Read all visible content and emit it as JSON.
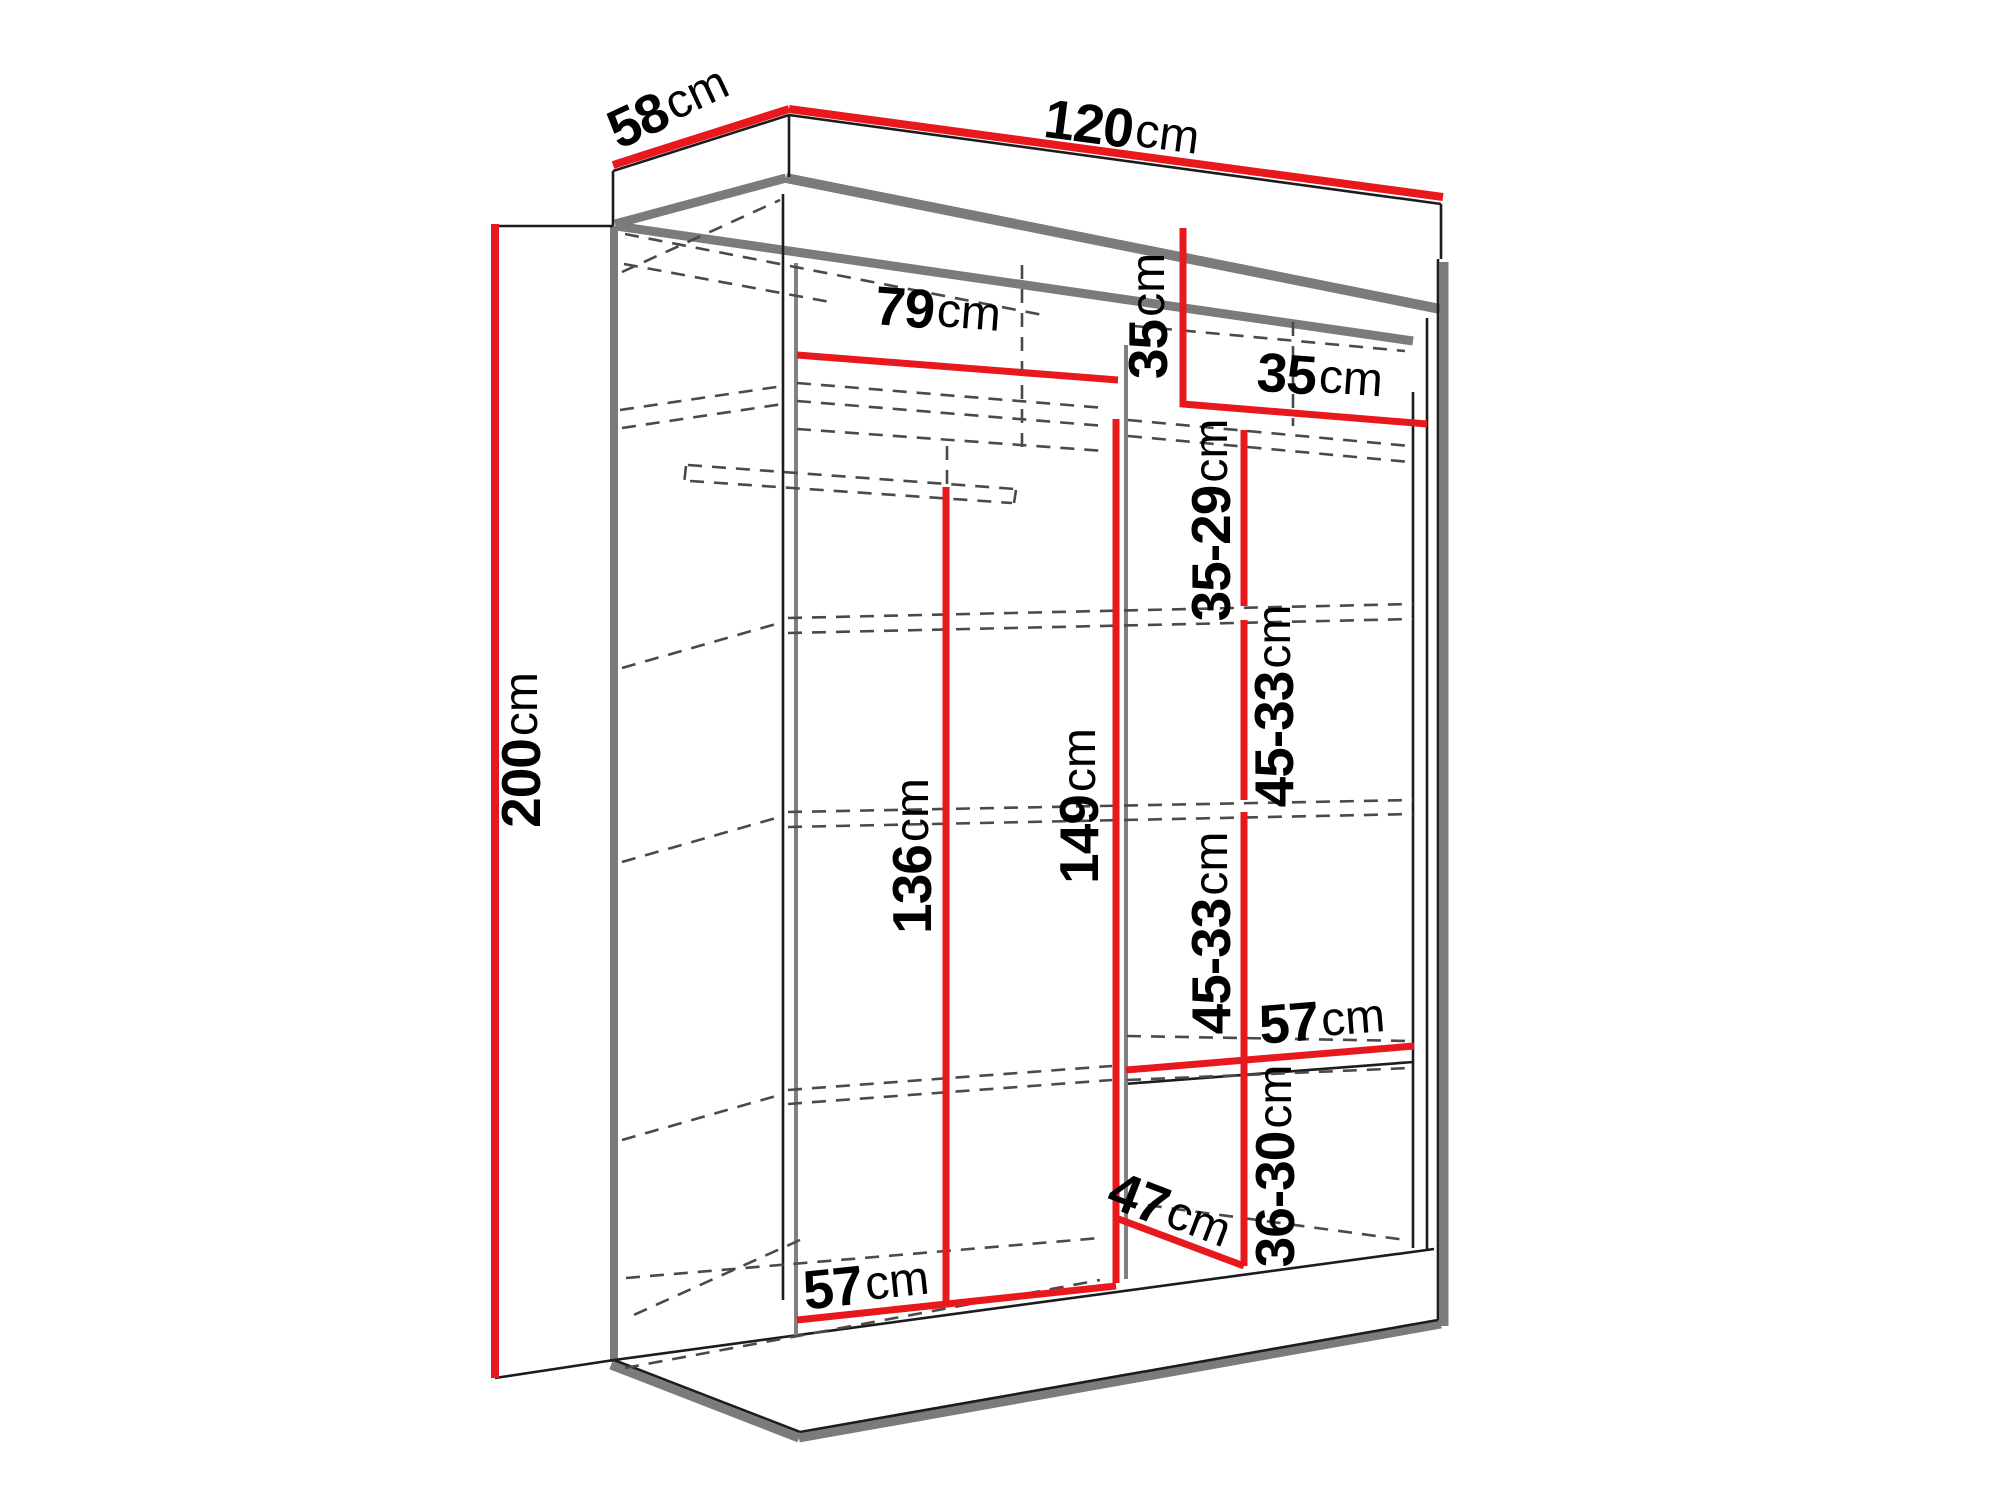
{
  "title": "Wardrobe dimension diagram",
  "canvas": {
    "width": 2000,
    "height": 1500,
    "background": "#ffffff"
  },
  "colors": {
    "dimension_red": "#e8181c",
    "outline_black": "#1c1c1c",
    "shadow_gray": "#7b7b7b",
    "partition_gray": "#808080",
    "dashed_gray": "#4a4a4a",
    "label_black": "#000000"
  },
  "measurements": {
    "overall": {
      "width": "120cm",
      "depth": "58cm",
      "height": "200cm"
    },
    "left_section": {
      "top_interior_width": "79cm",
      "hanging_height": "136cm",
      "bottom_interior_width": "57cm"
    },
    "right_section": {
      "top_shelf_height": "35cm",
      "top_shelf_width": "35cm",
      "interior_height": "149cm",
      "shelf_gap_1": "35-29cm",
      "shelf_gap_2": "45-33cm",
      "shelf_gap_3": "45-33cm",
      "shelf_gap_4": "36-30cm",
      "shelf_width": "57cm",
      "bottom_compartment_width": "47cm"
    }
  },
  "labels": [
    {
      "id": "label-58cm",
      "value": "58",
      "unit": "cm",
      "x": 668,
      "y": 106,
      "rot": -25
    },
    {
      "id": "label-120cm",
      "value": "120",
      "unit": "cm",
      "x": 1122,
      "y": 128,
      "rot": 7.5
    },
    {
      "id": "label-200cm",
      "value": "200",
      "unit": "cm",
      "x": 521,
      "y": 750,
      "rot": -90
    },
    {
      "id": "label-79cm",
      "value": "79",
      "unit": "cm",
      "x": 938,
      "y": 310,
      "rot": 4.5
    },
    {
      "id": "label-35cm-left",
      "value": "35",
      "unit": "cm",
      "x": 1148,
      "y": 316,
      "rot": -90
    },
    {
      "id": "label-35cm-right",
      "value": "35",
      "unit": "cm",
      "x": 1320,
      "y": 376,
      "rot": 4
    },
    {
      "id": "label-35-29cm",
      "value": "35-29",
      "unit": "cm",
      "x": 1211,
      "y": 520,
      "rot": -90
    },
    {
      "id": "label-45-33cm-upper",
      "value": "45-33",
      "unit": "cm",
      "x": 1274,
      "y": 706,
      "rot": -90
    },
    {
      "id": "label-136cm",
      "value": "136",
      "unit": "cm",
      "x": 912,
      "y": 856,
      "rot": -90
    },
    {
      "id": "label-149cm",
      "value": "149",
      "unit": "cm",
      "x": 1079,
      "y": 806,
      "rot": -90
    },
    {
      "id": "label-45-33cm-lower",
      "value": "45-33",
      "unit": "cm",
      "x": 1211,
      "y": 933,
      "rot": -90
    },
    {
      "id": "label-57cm-right",
      "value": "57",
      "unit": "cm",
      "x": 1322,
      "y": 1020,
      "rot": -4.5
    },
    {
      "id": "label-36-30cm",
      "value": "36-30",
      "unit": "cm",
      "x": 1275,
      "y": 1166,
      "rot": -90
    },
    {
      "id": "label-47cm",
      "value": "47",
      "unit": "cm",
      "x": 1170,
      "y": 1210,
      "rot": 21
    },
    {
      "id": "label-57cm-bottom",
      "value": "57",
      "unit": "cm",
      "x": 866,
      "y": 1284,
      "rot": -6
    }
  ],
  "dimension_lines": [
    {
      "id": "dimline-58cm",
      "w": 8,
      "points": [
        [
          613,
          165
        ],
        [
          789,
          109
        ]
      ]
    },
    {
      "id": "dimline-120cm",
      "w": 8,
      "points": [
        [
          789,
          109
        ],
        [
          1443,
          197
        ]
      ]
    },
    {
      "id": "dimline-200cm",
      "w": 8,
      "points": [
        [
          495,
          224
        ],
        [
          495,
          1378
        ]
      ]
    },
    {
      "id": "dimline-79cm",
      "w": 7,
      "points": [
        [
          797,
          355
        ],
        [
          1118,
          380
        ]
      ]
    },
    {
      "id": "dimline-35cm-L",
      "w": 7,
      "points": [
        [
          1183,
          228
        ],
        [
          1183,
          404
        ],
        [
          1427,
          424
        ]
      ]
    },
    {
      "id": "dimline-35-29cm",
      "w": 7,
      "points": [
        [
          1244,
          430
        ],
        [
          1244,
          606
        ]
      ]
    },
    {
      "id": "dimline-45-33cm-upper",
      "w": 7,
      "points": [
        [
          1244,
          620
        ],
        [
          1244,
          800
        ]
      ]
    },
    {
      "id": "dimline-45-33cm-lower",
      "w": 7,
      "points": [
        [
          1244,
          812
        ],
        [
          1244,
          1056
        ]
      ]
    },
    {
      "id": "dimline-136cm",
      "w": 7,
      "points": [
        [
          946,
          487
        ],
        [
          946,
          1303
        ]
      ]
    },
    {
      "id": "dimline-149cm",
      "w": 7,
      "points": [
        [
          1116,
          419
        ],
        [
          1116,
          1283
        ]
      ]
    },
    {
      "id": "dimline-57cm-right",
      "w": 7,
      "points": [
        [
          1126,
          1070
        ],
        [
          1414,
          1046
        ]
      ]
    },
    {
      "id": "dimline-36-30cm",
      "w": 7,
      "points": [
        [
          1244,
          1056
        ],
        [
          1244,
          1266
        ]
      ]
    },
    {
      "id": "dimline-47cm",
      "w": 7,
      "points": [
        [
          1116,
          1218
        ],
        [
          1244,
          1266
        ]
      ]
    },
    {
      "id": "dimline-57cm-bottom",
      "w": 7,
      "points": [
        [
          797,
          1320
        ],
        [
          1116,
          1286
        ]
      ]
    }
  ],
  "outlines": [
    {
      "id": "crown-top-left-edge",
      "pts": [
        613,
        171,
        789,
        115
      ]
    },
    {
      "id": "crown-top-right-edge",
      "pts": [
        789,
        115,
        1441,
        204
      ]
    },
    {
      "id": "crown-peak-vertical",
      "pts": [
        789,
        115,
        789,
        177
      ]
    },
    {
      "id": "crown-left-vertical",
      "pts": [
        613,
        171,
        613,
        226
      ]
    },
    {
      "id": "crown-right-vertical",
      "pts": [
        1441,
        204,
        1441,
        259
      ]
    },
    {
      "id": "tick-200-top",
      "pts": [
        495,
        226,
        613,
        226
      ]
    },
    {
      "id": "tick-200-bottom",
      "pts": [
        495,
        1378,
        614,
        1360
      ]
    },
    {
      "id": "back-left-corner-edge",
      "pts": [
        783,
        194,
        783,
        1300
      ]
    },
    {
      "id": "right-inner-edge-a",
      "pts": [
        1413,
        392,
        1413,
        1248
      ]
    },
    {
      "id": "right-inner-edge-b",
      "pts": [
        1427,
        318,
        1427,
        1250
      ]
    },
    {
      "id": "right-outer-edge",
      "pts": [
        1438,
        259,
        1438,
        1320
      ]
    },
    {
      "id": "floor-front-edge",
      "pts": [
        614,
        1360,
        1434,
        1249
      ]
    },
    {
      "id": "plinth-left-bottom",
      "pts": [
        614,
        1360,
        800,
        1432
      ]
    },
    {
      "id": "plinth-front-bottom",
      "pts": [
        800,
        1432,
        1438,
        1320
      ]
    },
    {
      "id": "bottom-shelf-front",
      "pts": [
        1124,
        1084,
        1413,
        1062
      ]
    }
  ],
  "shadows": [
    {
      "id": "crown-underside-left",
      "w": 9,
      "pts": [
        615,
        224,
        786,
        178
      ]
    },
    {
      "id": "crown-underside-front",
      "w": 10,
      "pts": [
        786,
        178,
        1440,
        309
      ]
    },
    {
      "id": "interior-ceiling-back",
      "w": 9,
      "pts": [
        616,
        226,
        1413,
        341
      ]
    },
    {
      "id": "left-outer-edge",
      "w": 8,
      "pts": [
        614,
        226,
        614,
        1362
      ]
    },
    {
      "id": "right-outer-shadow",
      "w": 9,
      "pts": [
        1444,
        262,
        1444,
        1326
      ]
    },
    {
      "id": "plinth-left-shadow",
      "w": 9,
      "pts": [
        611,
        1365,
        799,
        1438
      ]
    },
    {
      "id": "plinth-front-shadow",
      "w": 9,
      "pts": [
        799,
        1438,
        1441,
        1324
      ]
    }
  ],
  "partitions": [
    {
      "id": "center-partition",
      "w": 4,
      "pts": [
        1126,
        345,
        1126,
        1279
      ]
    },
    {
      "id": "left-inner-edge",
      "w": 4,
      "pts": [
        796,
        263,
        796,
        1336
      ]
    }
  ],
  "dashed_lines": [
    {
      "id": "dash-top-strip-diag",
      "pts": [
        622,
        272,
        780,
        200
      ]
    },
    {
      "id": "dash-top-back-long",
      "pts": [
        625,
        234,
        1048,
        316
      ]
    },
    {
      "id": "dash-top-back-short",
      "pts": [
        624,
        264,
        830,
        302
      ]
    },
    {
      "id": "dash-top-back-right",
      "pts": [
        1134,
        326,
        1405,
        351
      ]
    },
    {
      "id": "dash-partition-back",
      "pts": [
        1022,
        265,
        1022,
        448
      ]
    },
    {
      "id": "dash-right-back-vert",
      "pts": [
        1293,
        322,
        1293,
        426
      ]
    },
    {
      "id": "dash-shelf1-int-a",
      "pts": [
        797,
        383,
        1105,
        408
      ]
    },
    {
      "id": "dash-shelf1-int-b",
      "pts": [
        797,
        401,
        1105,
        426
      ]
    },
    {
      "id": "dash-shelf1-int-c",
      "pts": [
        797,
        429,
        1105,
        451
      ]
    },
    {
      "id": "dash-shelf1-strip-a",
      "pts": [
        620,
        410,
        783,
        386
      ]
    },
    {
      "id": "dash-shelf1-strip-b",
      "pts": [
        622,
        428,
        783,
        404
      ]
    },
    {
      "id": "dash-rail-top",
      "pts": [
        688,
        465,
        1015,
        489
      ]
    },
    {
      "id": "dash-rail-bottom",
      "pts": [
        690,
        481,
        1012,
        503
      ]
    },
    {
      "id": "dash-rail-cap-left",
      "pts": [
        686,
        466,
        684,
        484
      ]
    },
    {
      "id": "dash-rail-cap-right",
      "pts": [
        1016,
        490,
        1014,
        503
      ]
    },
    {
      "id": "dash-rail-hanger",
      "pts": [
        947,
        446,
        947,
        484
      ]
    },
    {
      "id": "dash-shelf1R-a",
      "pts": [
        1128,
        420,
        1410,
        446
      ]
    },
    {
      "id": "dash-shelf1R-b",
      "pts": [
        1128,
        436,
        1410,
        462
      ]
    },
    {
      "id": "dash-shelf2-a",
      "pts": [
        788,
        618,
        1413,
        604
      ]
    },
    {
      "id": "dash-shelf2-b",
      "pts": [
        788,
        633,
        1413,
        619
      ]
    },
    {
      "id": "dash-shelf2-strip",
      "pts": [
        622,
        668,
        783,
        622
      ]
    },
    {
      "id": "dash-shelf3-a",
      "pts": [
        788,
        812,
        1413,
        800
      ]
    },
    {
      "id": "dash-shelf3-b",
      "pts": [
        788,
        827,
        1413,
        814
      ]
    },
    {
      "id": "dash-shelf3-strip",
      "pts": [
        622,
        862,
        783,
        816
      ]
    },
    {
      "id": "dash-shelf4-a",
      "pts": [
        788,
        1090,
        1112,
        1066
      ]
    },
    {
      "id": "dash-shelf4-b",
      "pts": [
        788,
        1104,
        1112,
        1080
      ]
    },
    {
      "id": "dash-shelf4-strip",
      "pts": [
        622,
        1140,
        783,
        1094
      ]
    },
    {
      "id": "dash-shelf4R-a",
      "pts": [
        1127,
        1036,
        1410,
        1041
      ]
    },
    {
      "id": "dash-shelf4R-b",
      "pts": [
        1127,
        1080,
        1410,
        1068
      ]
    },
    {
      "id": "dash-floor-back",
      "pts": [
        626,
        1278,
        1100,
        1238
      ]
    },
    {
      "id": "dash-floor-corner",
      "pts": [
        800,
        1240,
        627,
        1318
      ]
    },
    {
      "id": "dash-floor-hidden",
      "pts": [
        625,
        1368,
        1100,
        1280
      ]
    },
    {
      "id": "dash-floor-right",
      "pts": [
        1124,
        1202,
        1406,
        1240
      ]
    }
  ]
}
